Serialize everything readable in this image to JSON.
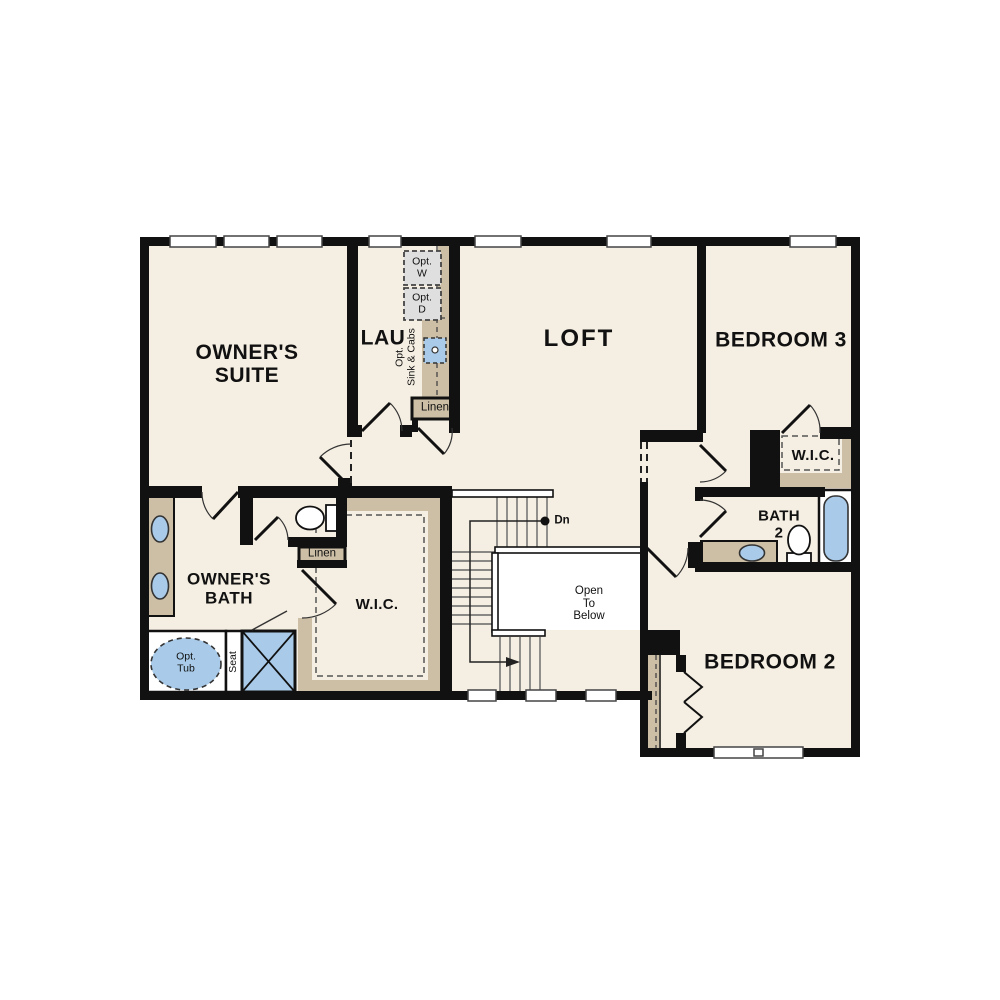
{
  "plan_title": "Second Floor Plan",
  "rooms": {
    "owners_suite": {
      "line1": "OWNER'S",
      "line2": "SUITE"
    },
    "lau": {
      "line1": "LAU"
    },
    "loft": {
      "line1": "LOFT"
    },
    "bedroom3": {
      "line1": "BEDROOM 3"
    },
    "wic_bed3": {
      "line1": "W.I.C."
    },
    "bath2": {
      "line1": "BATH",
      "line2": "2"
    },
    "bedroom2": {
      "line1": "BEDROOM 2"
    },
    "owners_bath": {
      "line1": "OWNER'S",
      "line2": "BATH"
    },
    "wic_owners": {
      "line1": "W.I.C."
    }
  },
  "annotations": {
    "stairs_down": "Dn",
    "open_to_below": {
      "line1": "Open",
      "line2": "To",
      "line3": "Below"
    },
    "linen_upper": "Linen",
    "linen_lower": "Linen",
    "opt_washer": {
      "line1": "Opt.",
      "line2": "W"
    },
    "opt_dryer": {
      "line1": "Opt.",
      "line2": "D"
    },
    "opt_sink_cabs": {
      "line1": "Opt.",
      "line2": "Sink & Cabs"
    },
    "opt_tub": {
      "line1": "Opt.",
      "line2": "Tub"
    },
    "seat": "Seat"
  },
  "colors": {
    "wall": "#111111",
    "floor": "#f5eee2",
    "counter_tan": "#cdbfa6",
    "fixture_blue": "#a9cbe9",
    "appliance_gray": "#dfdfdf",
    "open_well_white": "#ffffff",
    "tread_line": "#666666"
  }
}
